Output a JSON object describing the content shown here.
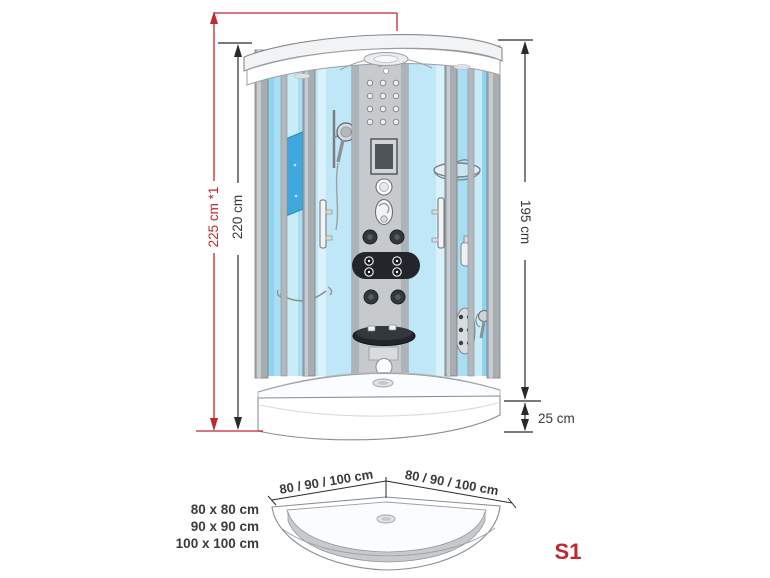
{
  "colors": {
    "accent": "#c1272d",
    "dim_line": "#2a2a2a",
    "glass_light": "#a9ddf2",
    "glass_door": "#bfe7f7",
    "seat_blue": "#3fa9df",
    "frame_gray": "#a8adb2"
  },
  "main_view": {
    "dim_total_height": "225 cm *1",
    "dim_cabin_height": "220 cm",
    "dim_glass_height": "195 cm",
    "dim_tray_height": "25 cm"
  },
  "tray_view": {
    "dim_side_left": "80 / 90 / 100 cm",
    "dim_side_right": "80 / 90 / 100 cm",
    "sizes": [
      "80 x 80 cm",
      "90 x 90 cm",
      "100 x 100 cm"
    ],
    "model_label": "S1"
  }
}
